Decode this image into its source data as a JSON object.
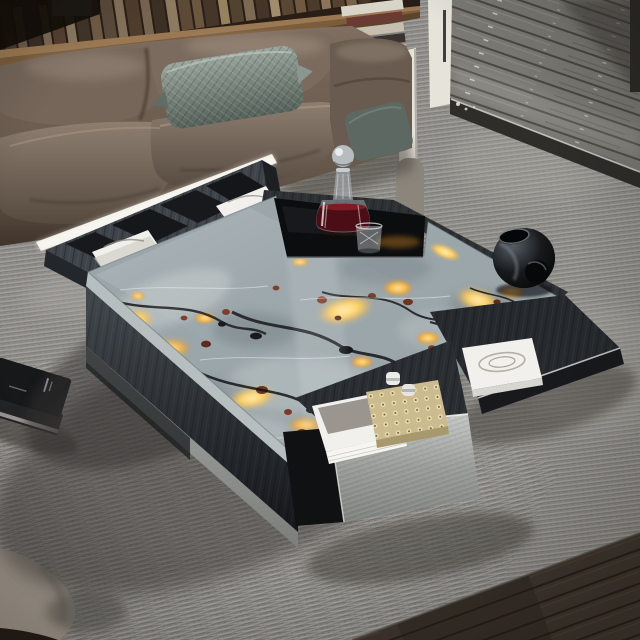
{
  "scene": {
    "alt": "Modern living room product photo: square coffee table with glowing grey-and-amber stone top, storage drawers and compartments, in front of a brown leather sofa on a ribbed grey rug, with a weathered wood terrace beyond a white door frame",
    "colors": {
      "carpet": "#8f8d89",
      "carpet_shadow": "#45433f",
      "deck": "#7a7973",
      "hardwood": "#3b332b",
      "doorframe": "#e6e3db",
      "bookshelf": "#281e16",
      "console": "#7b5c3b",
      "sofa": "#6f5f53",
      "pillow": "#7e8b84",
      "pillow2": "#5d6862",
      "table_wood": "#3f444a",
      "table_wood_dark": "#1d2023",
      "stone": "#9ba6aa",
      "amber": "#f0ac40",
      "rust": "#7c3a25",
      "vein": "#141518",
      "tray": "#0c0d0f",
      "mirror": "#aeb2af",
      "liquid": "#4c0e16",
      "vase": "#141619",
      "book": "#f1f0ec",
      "gold": "#cbbb8f",
      "strip": "#efece1",
      "ottoman": "#a79e92",
      "chair_gray": "#8b857c"
    },
    "objects": {
      "sofa": "brown leather modular sofa",
      "pillow_main": "sage quilted throw pillow",
      "pillow_side": "dark sage pillow on armrest",
      "table": "square coffee table with backlit stone top",
      "tray": "black glass tray inset",
      "decanter": "crystal decanter with red liquor",
      "glass": "faceted crystal tumbler",
      "vase": "black sculptural vase",
      "compartment_books": "white books in rear compartments",
      "front_book": "white coffee-table book in front drawer",
      "right_book": "white book with embossed emblem in side drawer",
      "gold_box": "studded brass decor box",
      "rug": "ribbed grey area rug",
      "deck": "weathered wood terrace",
      "door": "white door frame",
      "bookshelf": "book-filled shelf behind sofa",
      "floor_books": "stack of black magazines on rug",
      "ottoman": "light grey ottoman corner",
      "floor": "dark hardwood floor"
    }
  }
}
